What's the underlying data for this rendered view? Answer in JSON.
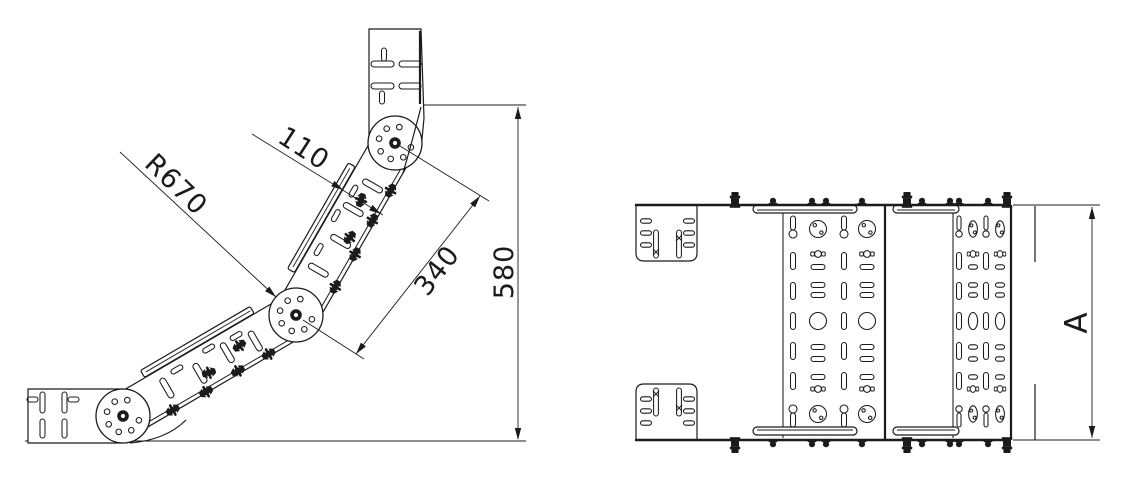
{
  "drawing": {
    "type": "technical-drawing",
    "views": [
      "side-elevation",
      "plan"
    ],
    "dimensions": {
      "radius": "R670",
      "width": "110",
      "length": "340",
      "height": "580",
      "overall": "A"
    },
    "colors": {
      "ink": "#1b1b1b",
      "paper": "#ffffff"
    }
  }
}
